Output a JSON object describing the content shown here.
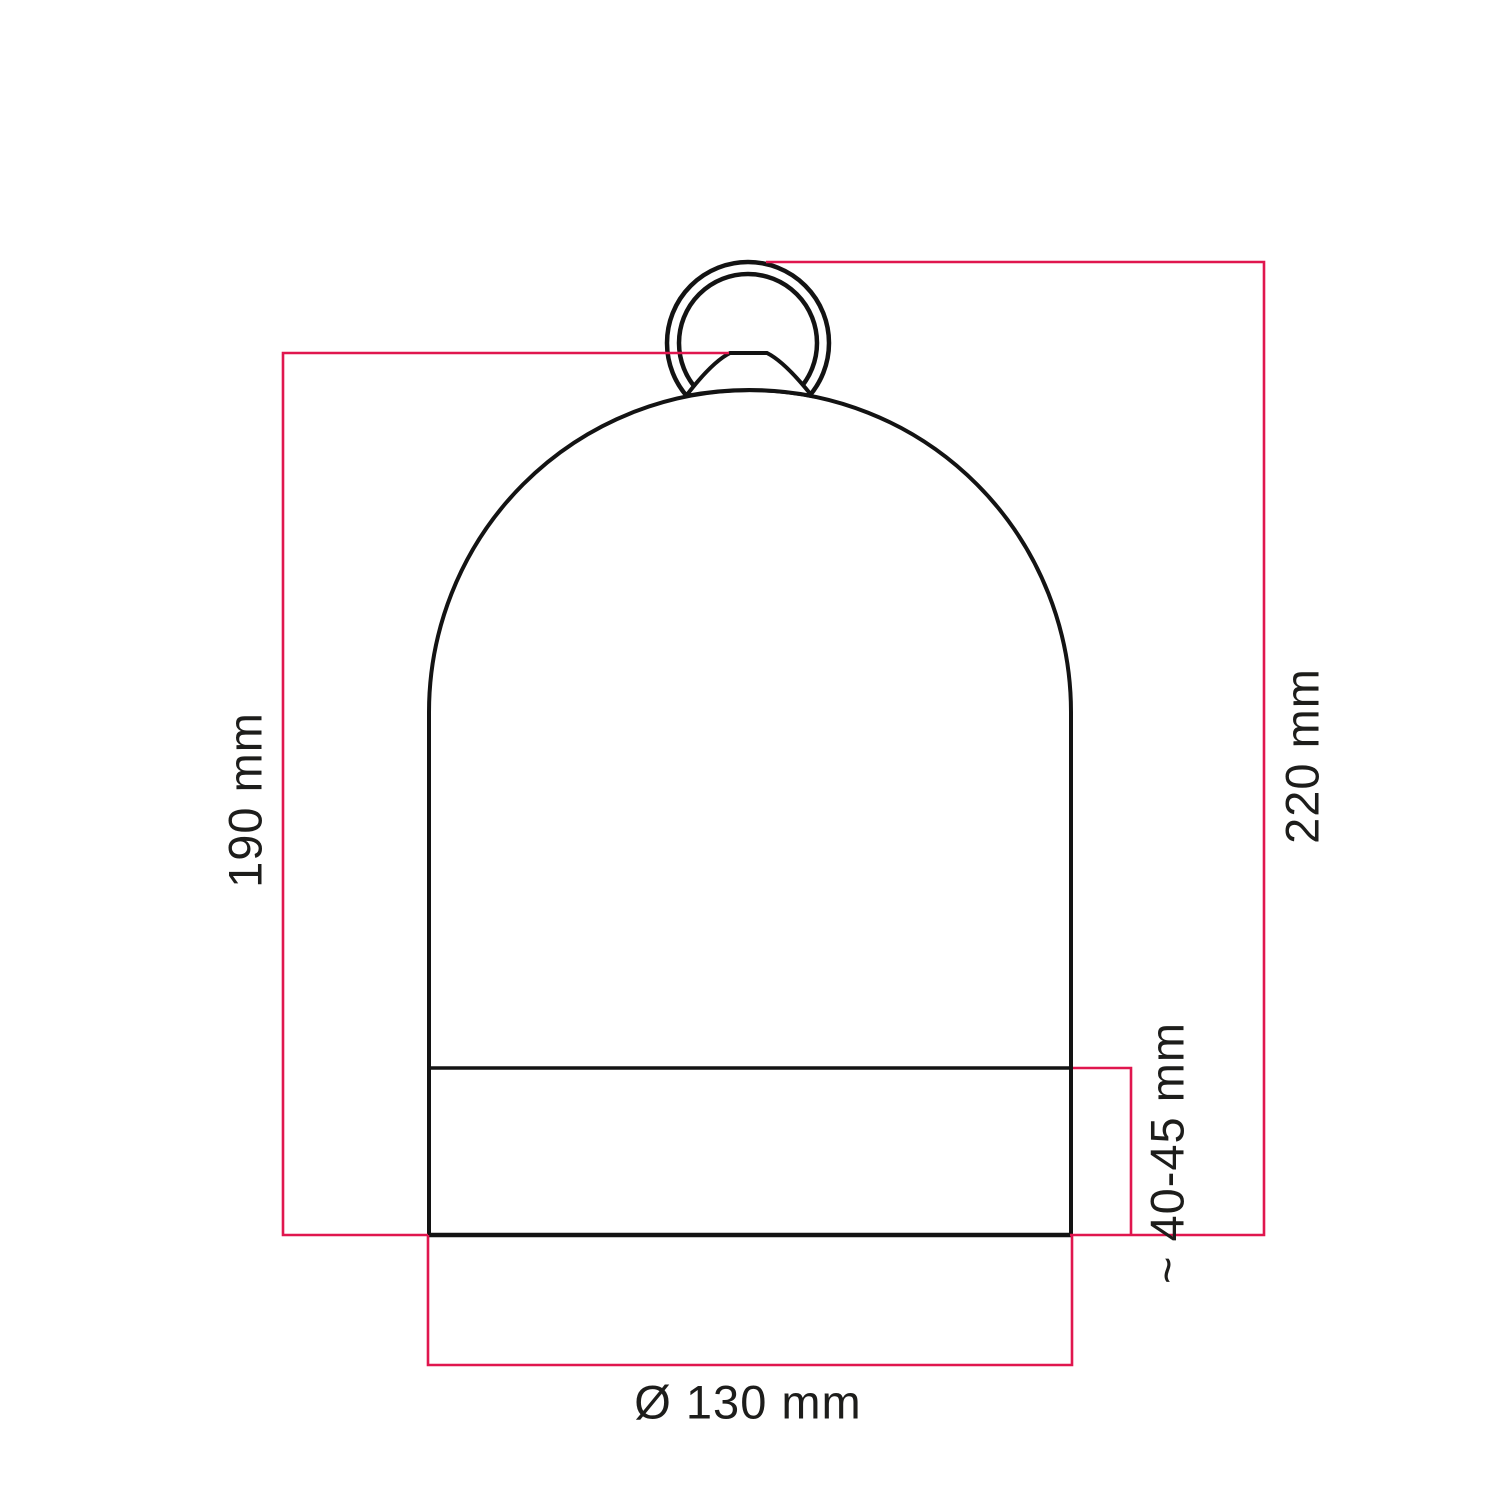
{
  "drawing": {
    "labels": {
      "shade_height": "190 mm",
      "total_height": "220 mm",
      "base_height": "~ 40-45 mm",
      "diameter": "Ø 130 mm"
    },
    "colors": {
      "dimension_line": "#e0164e",
      "outline": "#131313",
      "text": "#1d1d1b",
      "background": "#ffffff"
    }
  }
}
